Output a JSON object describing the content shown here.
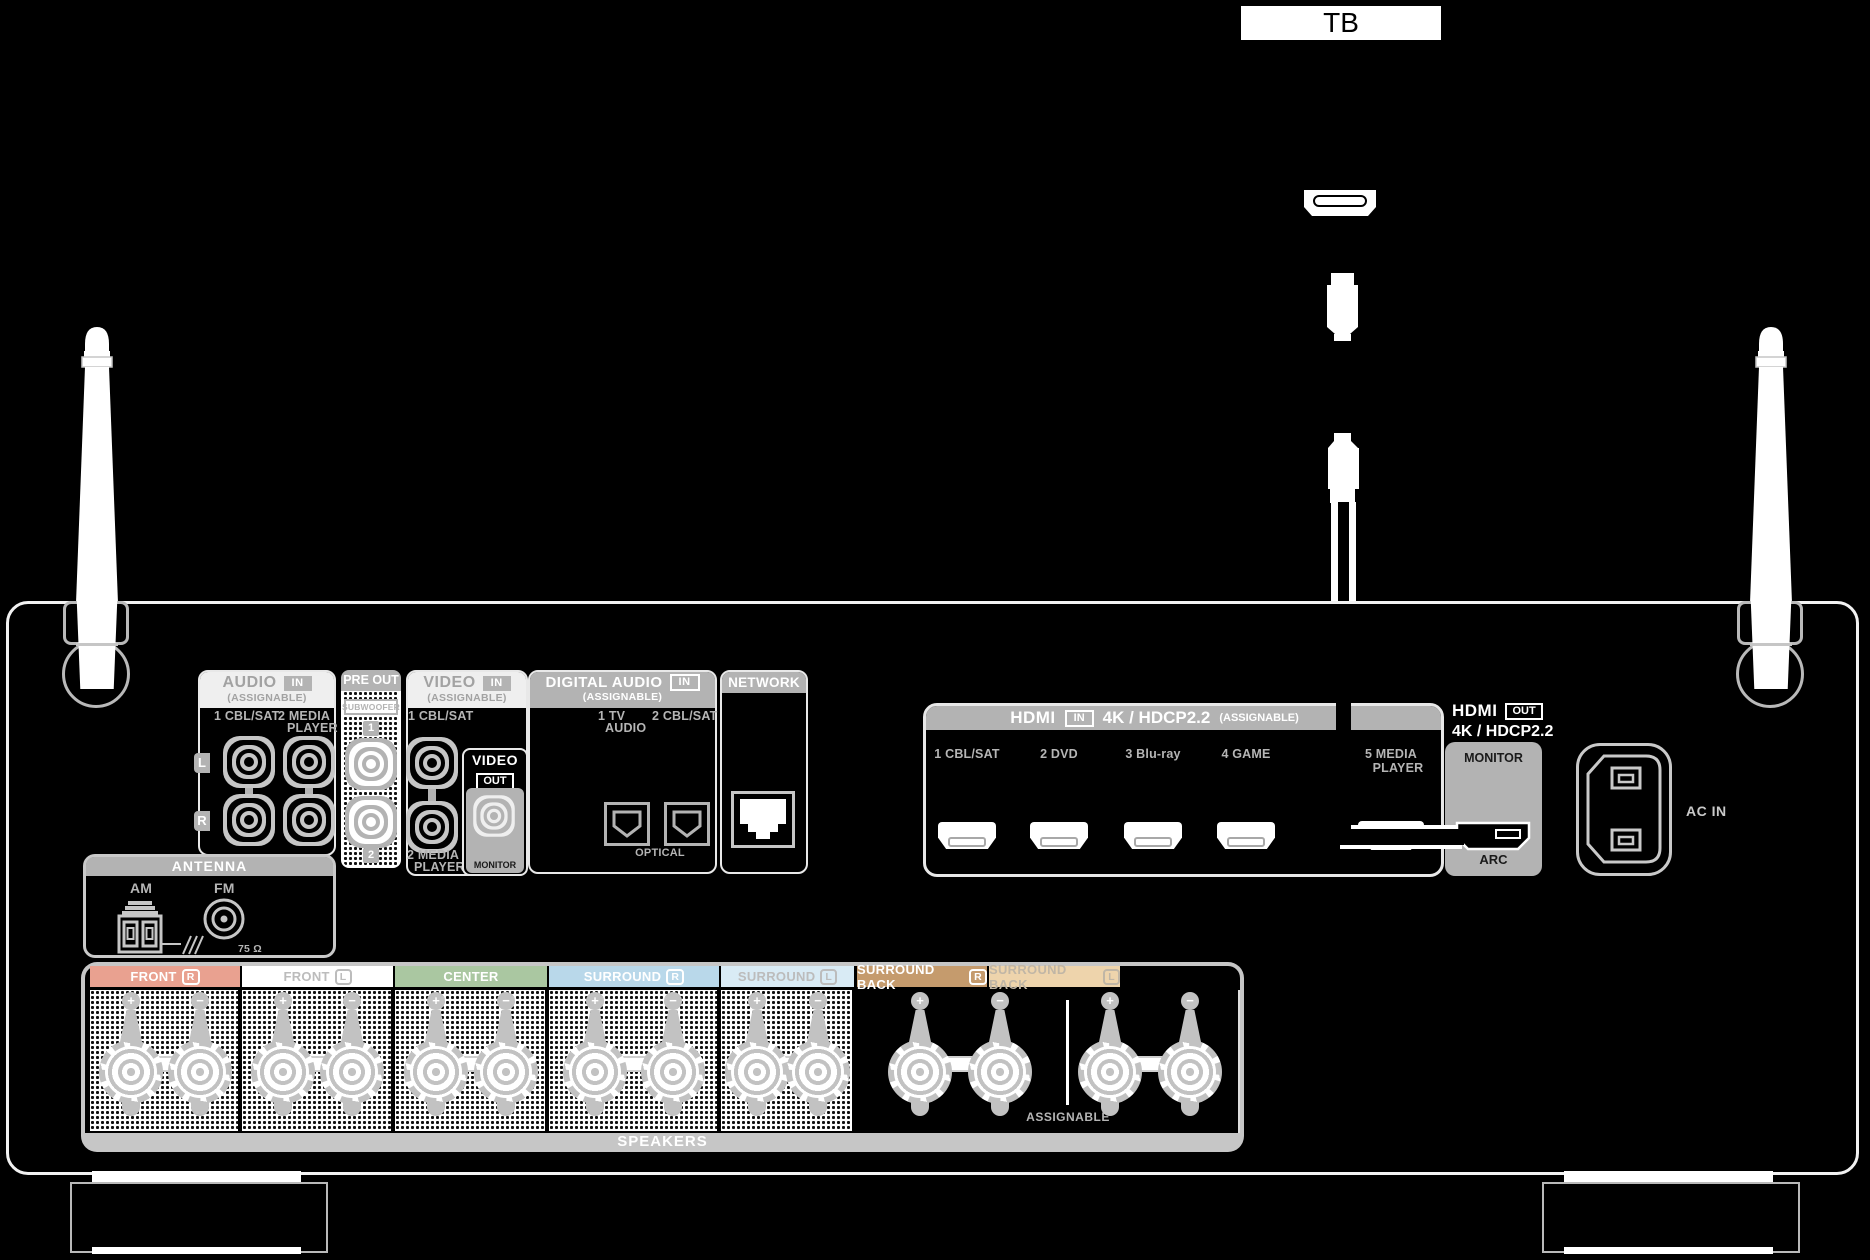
{
  "tv": {
    "label": "TB"
  },
  "audio_in": {
    "title": "AUDIO",
    "badge": "IN",
    "assignable": "(ASSIGNABLE)",
    "label_1": "1 CBL/SAT",
    "label_2a": "2 MEDIA",
    "label_2b": "PLAYER",
    "left": "L",
    "right": "R"
  },
  "pre_out": {
    "title": "PRE OUT",
    "subwoofer": "SUBWOOFER",
    "jack_1": "1",
    "jack_2": "2"
  },
  "video_in": {
    "title": "VIDEO",
    "badge": "IN",
    "assignable": "(ASSIGNABLE)",
    "label_1": "1 CBL/SAT",
    "label_2a": "2 MEDIA",
    "label_2b": "PLAYER"
  },
  "video_out": {
    "title": "VIDEO",
    "badge": "OUT",
    "monitor": "MONITOR"
  },
  "digital_audio": {
    "title": "DIGITAL AUDIO",
    "badge": "IN",
    "assignable": "(ASSIGNABLE)",
    "label_1a": "1 TV",
    "label_1b": "AUDIO",
    "label_2": "2 CBL/SAT",
    "optical": "OPTICAL"
  },
  "network": {
    "title": "NETWORK"
  },
  "hdmi_in": {
    "title": "HDMI",
    "badge": "IN",
    "spec": "4K / HDCP2.2",
    "assignable": "(ASSIGNABLE)",
    "ports": [
      {
        "num": "1",
        "name": "CBL/SAT"
      },
      {
        "num": "2",
        "name": "DVD"
      },
      {
        "num": "3",
        "name": "Blu-ray"
      },
      {
        "num": "4",
        "name": "GAME"
      },
      {
        "num": "5",
        "name": "MEDIA",
        "name2": "PLAYER"
      }
    ]
  },
  "hdmi_out": {
    "title": "HDMI",
    "badge": "OUT",
    "spec": "4K / HDCP2.2",
    "monitor": "MONITOR",
    "arc": "ARC"
  },
  "power": {
    "label": "AC IN"
  },
  "antenna": {
    "title": "ANTENNA",
    "am": "AM",
    "fm": "FM",
    "impedance": "75 Ω"
  },
  "speakers": {
    "title": "SPEAKERS",
    "assignable": "ASSIGNABLE",
    "plus": "+",
    "minus": "−",
    "channels": [
      {
        "label": "FRONT",
        "badge": "R",
        "bar_color": "#e9a190",
        "text_color": "#ffffff"
      },
      {
        "label": "FRONT",
        "badge": "L",
        "bar_color": "#ffffff",
        "text_color": "#bcbcbc"
      },
      {
        "label": "CENTER",
        "badge": "",
        "bar_color": "#aac7a1",
        "text_color": "#ffffff"
      },
      {
        "label": "SURROUND",
        "badge": "R",
        "bar_color": "#b9d8ea",
        "text_color": "#ffffff"
      },
      {
        "label": "SURROUND",
        "badge": "L",
        "bar_color": "#d9ebf5",
        "text_color": "#bcbcbc"
      },
      {
        "label": "SURROUND BACK",
        "badge": "R",
        "bar_color": "#c59b6d",
        "text_color": "#ffffff"
      },
      {
        "label": "SURROUND BACK",
        "badge": "L",
        "bar_color": "#eed4ac",
        "text_color": "#c0b6a6"
      }
    ]
  },
  "colors": {
    "header_gray": "#b3b3b3",
    "light_header": "#efefef",
    "panel_line": "#f2f2f2",
    "label_gray": "#b5b5b5",
    "metal_gray": "#c6c6c6",
    "background": "#000000"
  }
}
